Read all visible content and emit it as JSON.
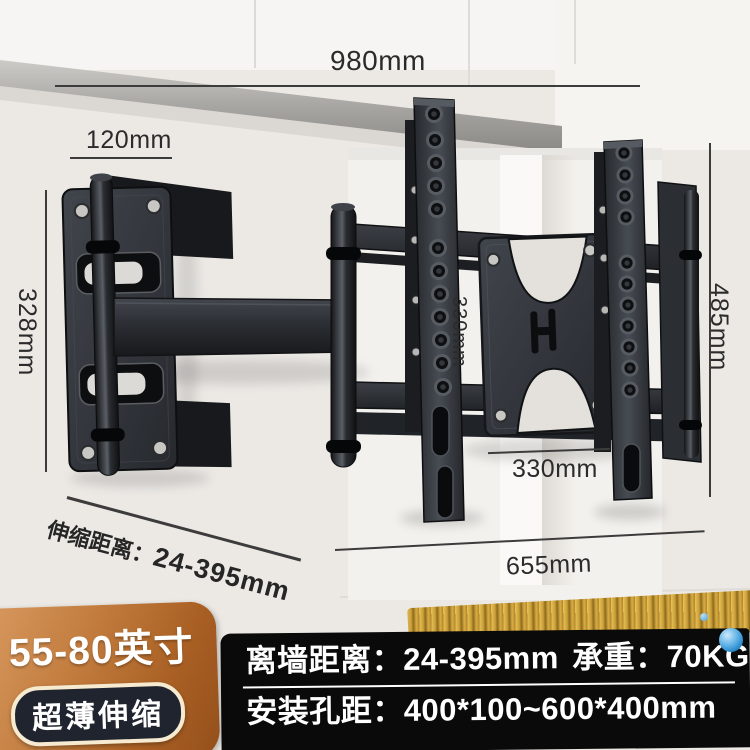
{
  "dims": {
    "top_width": "980mm",
    "wall_plate_width": "120mm",
    "wall_plate_height": "328mm",
    "bracket_height": "485mm",
    "vesa_vertical": "330mm",
    "vesa_horizontal": "330mm",
    "bracket_width": "655mm",
    "extension_label": "伸缩距离：",
    "extension_value": "24-395mm"
  },
  "badge": {
    "size_range": "55-80英寸",
    "feature": "超薄伸缩"
  },
  "spec_bar": {
    "wall_distance_label": "离墙距离：",
    "wall_distance_value": "24-395mm",
    "load_label": "承重：",
    "load_value": "70KG",
    "hole_pitch_label": "安装孔距：",
    "hole_pitch_value": "400*100~600*400mm"
  },
  "colors": {
    "badge_orange": "#b96a2e",
    "badge_pill_bg": "#20242e",
    "badge_pill_border": "#f6ead0",
    "spec_bar_bg": "#0a0a0b",
    "gold_strip": "#cfa13a",
    "accent_blue": "#2f95d8",
    "dimension_text": "#2b2b2b",
    "bracket_metal": "#2b2e33"
  }
}
